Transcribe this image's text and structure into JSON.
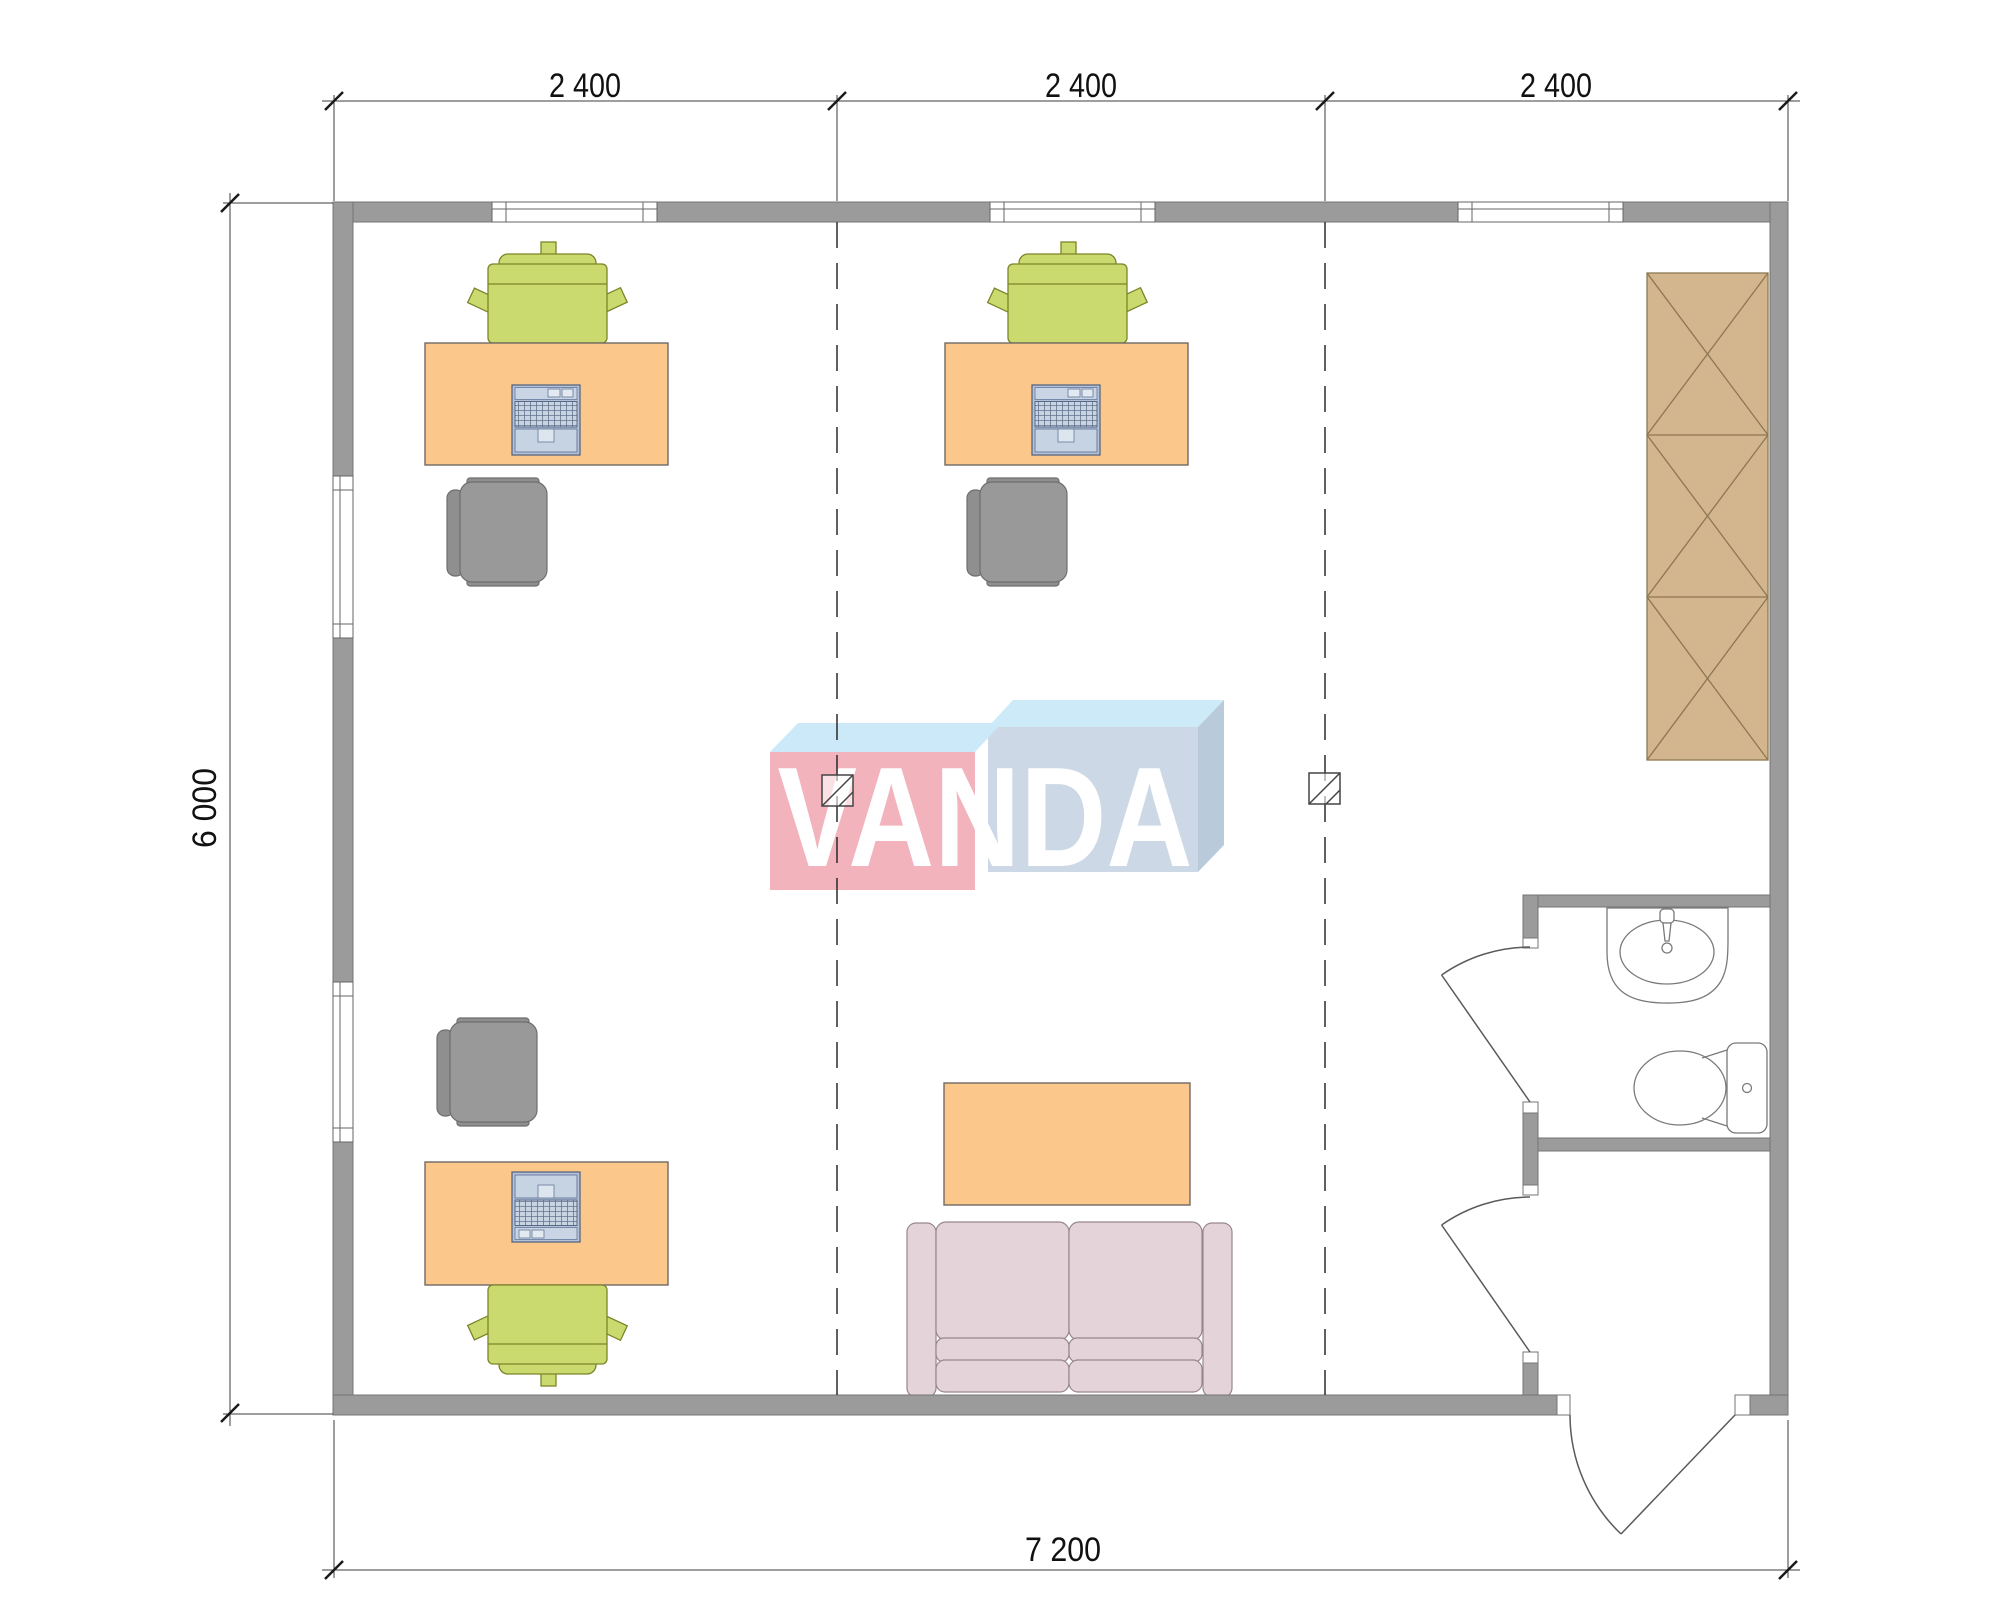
{
  "title": "Office floor plan 7200 x 6000",
  "watermark": {
    "text": "VANDA",
    "left_box_face_color": "#f3b3bd",
    "left_box_top_color": "#cbe9f8",
    "right_box_face_color": "#ccd8e5",
    "right_box_top_color": "#cdeaf9",
    "right_box_side_color": "#b9cbdb",
    "text_color": "#ffffff"
  },
  "dimensions": {
    "top": [
      "2 400",
      "2 400",
      "2 400"
    ],
    "left": "6 000",
    "bottom": "7 200"
  },
  "colors": {
    "wall": "#9b9b9b",
    "desk": "#fbc78a",
    "task_chair": "#cbda6e",
    "visitor_chair": "#999999",
    "wardrobe": "#d3b58e",
    "sofa": "#e4d4da",
    "coffee_table": "#fbc78a",
    "laptop": "#b3c2d8",
    "lines": "#3c3c3c"
  },
  "rooms": [
    "open-office",
    "bathroom",
    "entry-vestibule"
  ],
  "fixtures": {
    "desks": 3,
    "task_chairs": 3,
    "visitor_chairs": 3,
    "laptops": 3,
    "wardrobe_sections": 3,
    "sofa": 1,
    "coffee_table": 1,
    "sink": 1,
    "toilet": 1,
    "windows_top_wall": 3,
    "windows_left_wall": 2,
    "doors": 3,
    "ceiling_light_symbols": 2
  }
}
